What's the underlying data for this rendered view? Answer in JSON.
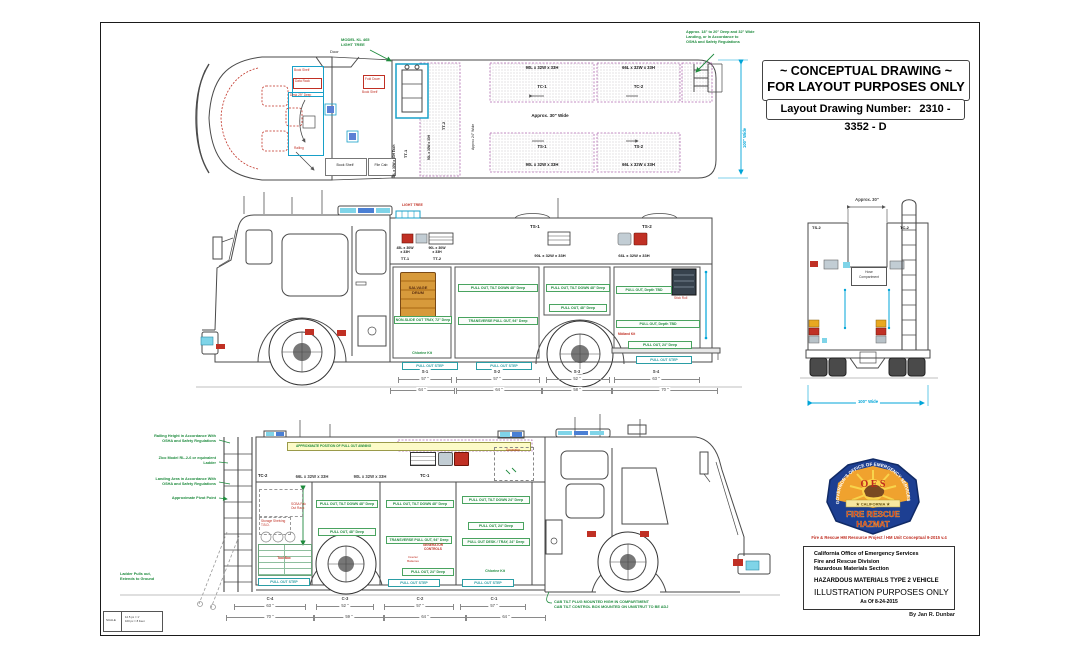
{
  "sheet": {
    "title_line1": "~ CONCEPTUAL DRAWING ~",
    "title_line2": "FOR LAYOUT PURPOSES ONLY",
    "drawing_number_label": "Layout Drawing Number:",
    "drawing_number": "2310 - 3352 - D",
    "scale_label": "SCALE",
    "scale_line1": "12.5 px = 1'",
    "scale_line2": "100 px = 8 Feet",
    "author": "By Jan R. Dunbar"
  },
  "colors": {
    "annotation_green": "#1f8b3e",
    "annotation_red": "#c03024",
    "dimension_cyan": "#00a5d8",
    "hatch_magenta": "#b06ab0",
    "awning_yellow": "#fdfbc8",
    "drum_orange": "#d79a3b",
    "badge_blue": "#1d3f92",
    "badge_gold": "#f0a22e"
  },
  "plan_view": {
    "light_tree_note": "MODEL KL 465\nLIGHT TREE",
    "door": "Door",
    "book_shelf_1": "Book Shelf",
    "data_rack": "Data Rack",
    "desk": "Desk 29\" Deep",
    "fold_down": "Fold Down",
    "book_shelf_2": "Book Shelf",
    "railing": "Railing",
    "book_shelf_3": "Book Shelf",
    "file_cab": "File Cab",
    "tt1_size": "45L x 30W x 33H Each",
    "tt1": "TT-1",
    "tt2_size": "90L x 30W x 33H",
    "tt2": "TT-2",
    "width_note": "Approx 24\" Wide",
    "tc1_size": "90L x 32W x 33H",
    "tc1": "TC-1",
    "tc2_size": "66L x 32W x 33H",
    "tc2": "TC-2",
    "aisle": "Approx. 30\" Wide",
    "ts1": "TS-1",
    "ts1_size": "90L x 32W x 33H",
    "ts2": "TS-2",
    "ts2_size": "66L x 32W x 33H",
    "landing_note": "Approx. 18\" to 20\" Deep and 32\" Wide\nLanding, or In Accordance to\nOSHA and Safety Regulations",
    "width_dim": "100\" Wide"
  },
  "side_view": {
    "light_tree": "LIGHT TREE",
    "tt1_size": "45L x 30W\nx 33H",
    "tt1": "TT-1",
    "tt2_size": "90L x 30W\nx 33H",
    "tt2": "TT-2",
    "ts1": "TS-1",
    "ts2": "TS-2",
    "ts1_size": "90L x 32W x 33H",
    "ts2_size": "66L x 32W x 33H",
    "drum": "SALVAGE\nDRUM",
    "tray72": "NON-SLIDE OUT TRAY, 72\" Deep",
    "chlorine_kit": "Chlorine Kit",
    "tilt48": "PULL OUT, TILT DOWN 48\" Deep",
    "transverse94": "TRANSVERSE PULL OUT, 94\" Deep",
    "pull48": "PULL OUT, 48\" Deep",
    "depth_tbd": "PULL OUT, Depth TBD",
    "midland_kit": "Midland Kit",
    "pull24": "PULL OUT, 24\" Deep",
    "stick_roll": "Stick Roll",
    "step": "PULL OUT STEP",
    "bays": [
      {
        "id": "S-1",
        "w1": "57 \"",
        "w2": "64 \""
      },
      {
        "id": "S-2",
        "w1": "57 \"",
        "w2": "64 \""
      },
      {
        "id": "S-3",
        "w1": "52 \"",
        "w2": "58 \""
      },
      {
        "id": "S-4",
        "w1": "63 \"",
        "w2": "70 \""
      }
    ]
  },
  "rear_view": {
    "top_dim": "Approx. 30\"",
    "ts2": "TS-2",
    "tc2": "TC-2",
    "compartment": "Hose\nCompartment",
    "width_dim": "100\" Wide"
  },
  "bottom_view": {
    "note_railing": "Railing Height in Accordance With\nOSHA and Safety Regulations",
    "note_ladder": "Zico Model RL-2-6 or equivalent\nLadder",
    "note_landing": "Landing Area in Accordance With\nOSHA and Safety Regulations",
    "note_pivot": "Approximate Pivot Point",
    "note_pulls_out": "Ladder Pulls out,\nExtends to Ground",
    "awning": "APPROXIMATE POSITION OF PULL OUT AWNING",
    "tc2": "TC-2",
    "tc1": "TC-1",
    "size_66": "66L x 32W x 33H",
    "size_90": "90L x 32W x 33H",
    "generator": "Generator",
    "storage_shelving": "Storage Shelving\nT.B.D.",
    "scba_rack": "SCBA Pak\nOut Rack",
    "tool_box": "Tool Box",
    "tilt48": "PULL OUT, TILT DOWN 48\" Deep",
    "pull48": "PULL OUT, 48\" Deep",
    "transverse94": "TRANSVERSE PULL OUT, 94\" Deep",
    "generator_controls": "GENERATOR\nCONTROLS",
    "inverter_batteries": "Inverter\nBatteries",
    "tilt24": "PULL OUT, TILT DOWN 24\" Deep",
    "pull24": "PULL OUT, 24\" Deep",
    "desk_tray": "PULL OUT DESK / TRAY, 24\" Deep",
    "chlorine_kit": "Chlorine Kit",
    "step": "PULL OUT STEP",
    "cab_note": "CAB TILT PLUG MOUNTED HIGH IN COMPARTMENT\nCAB TILT CONTROL BOX MOUNTED ON UNISTRUT TO BE ADJ",
    "bays": [
      {
        "id": "C-4",
        "w1": "63 \"",
        "w2": "70 \""
      },
      {
        "id": "C-3",
        "w1": "52 \"",
        "w2": "59 \""
      },
      {
        "id": "C-2",
        "w1": "57 \"",
        "w2": "64 \""
      },
      {
        "id": "C-1",
        "w1": "57 \"",
        "w2": "64 \""
      }
    ]
  },
  "badge": {
    "arc_text": "GOVERNOR'S OFFICE OF EMERGENCY SERVICES",
    "oes": "O E S",
    "california": "★ CALIFORNIA ★",
    "fire_rescue": "FIRE RESCUE",
    "hazmat": "HAZMAT"
  },
  "credits": {
    "project": "Fire & Rescue HM Resource Project / HM Unit Conceptual 9-2015 v.4",
    "org1": "California Office of Emergency Services",
    "org2": "Fire and Rescue Division",
    "org3": "Hazardous Materials Section",
    "vehicle": "HAZARDOUS MATERIALS TYPE 2 VEHICLE",
    "purpose": "ILLUSTRATION PURPOSES ONLY",
    "as_of": "As Of 8-24-2015"
  }
}
